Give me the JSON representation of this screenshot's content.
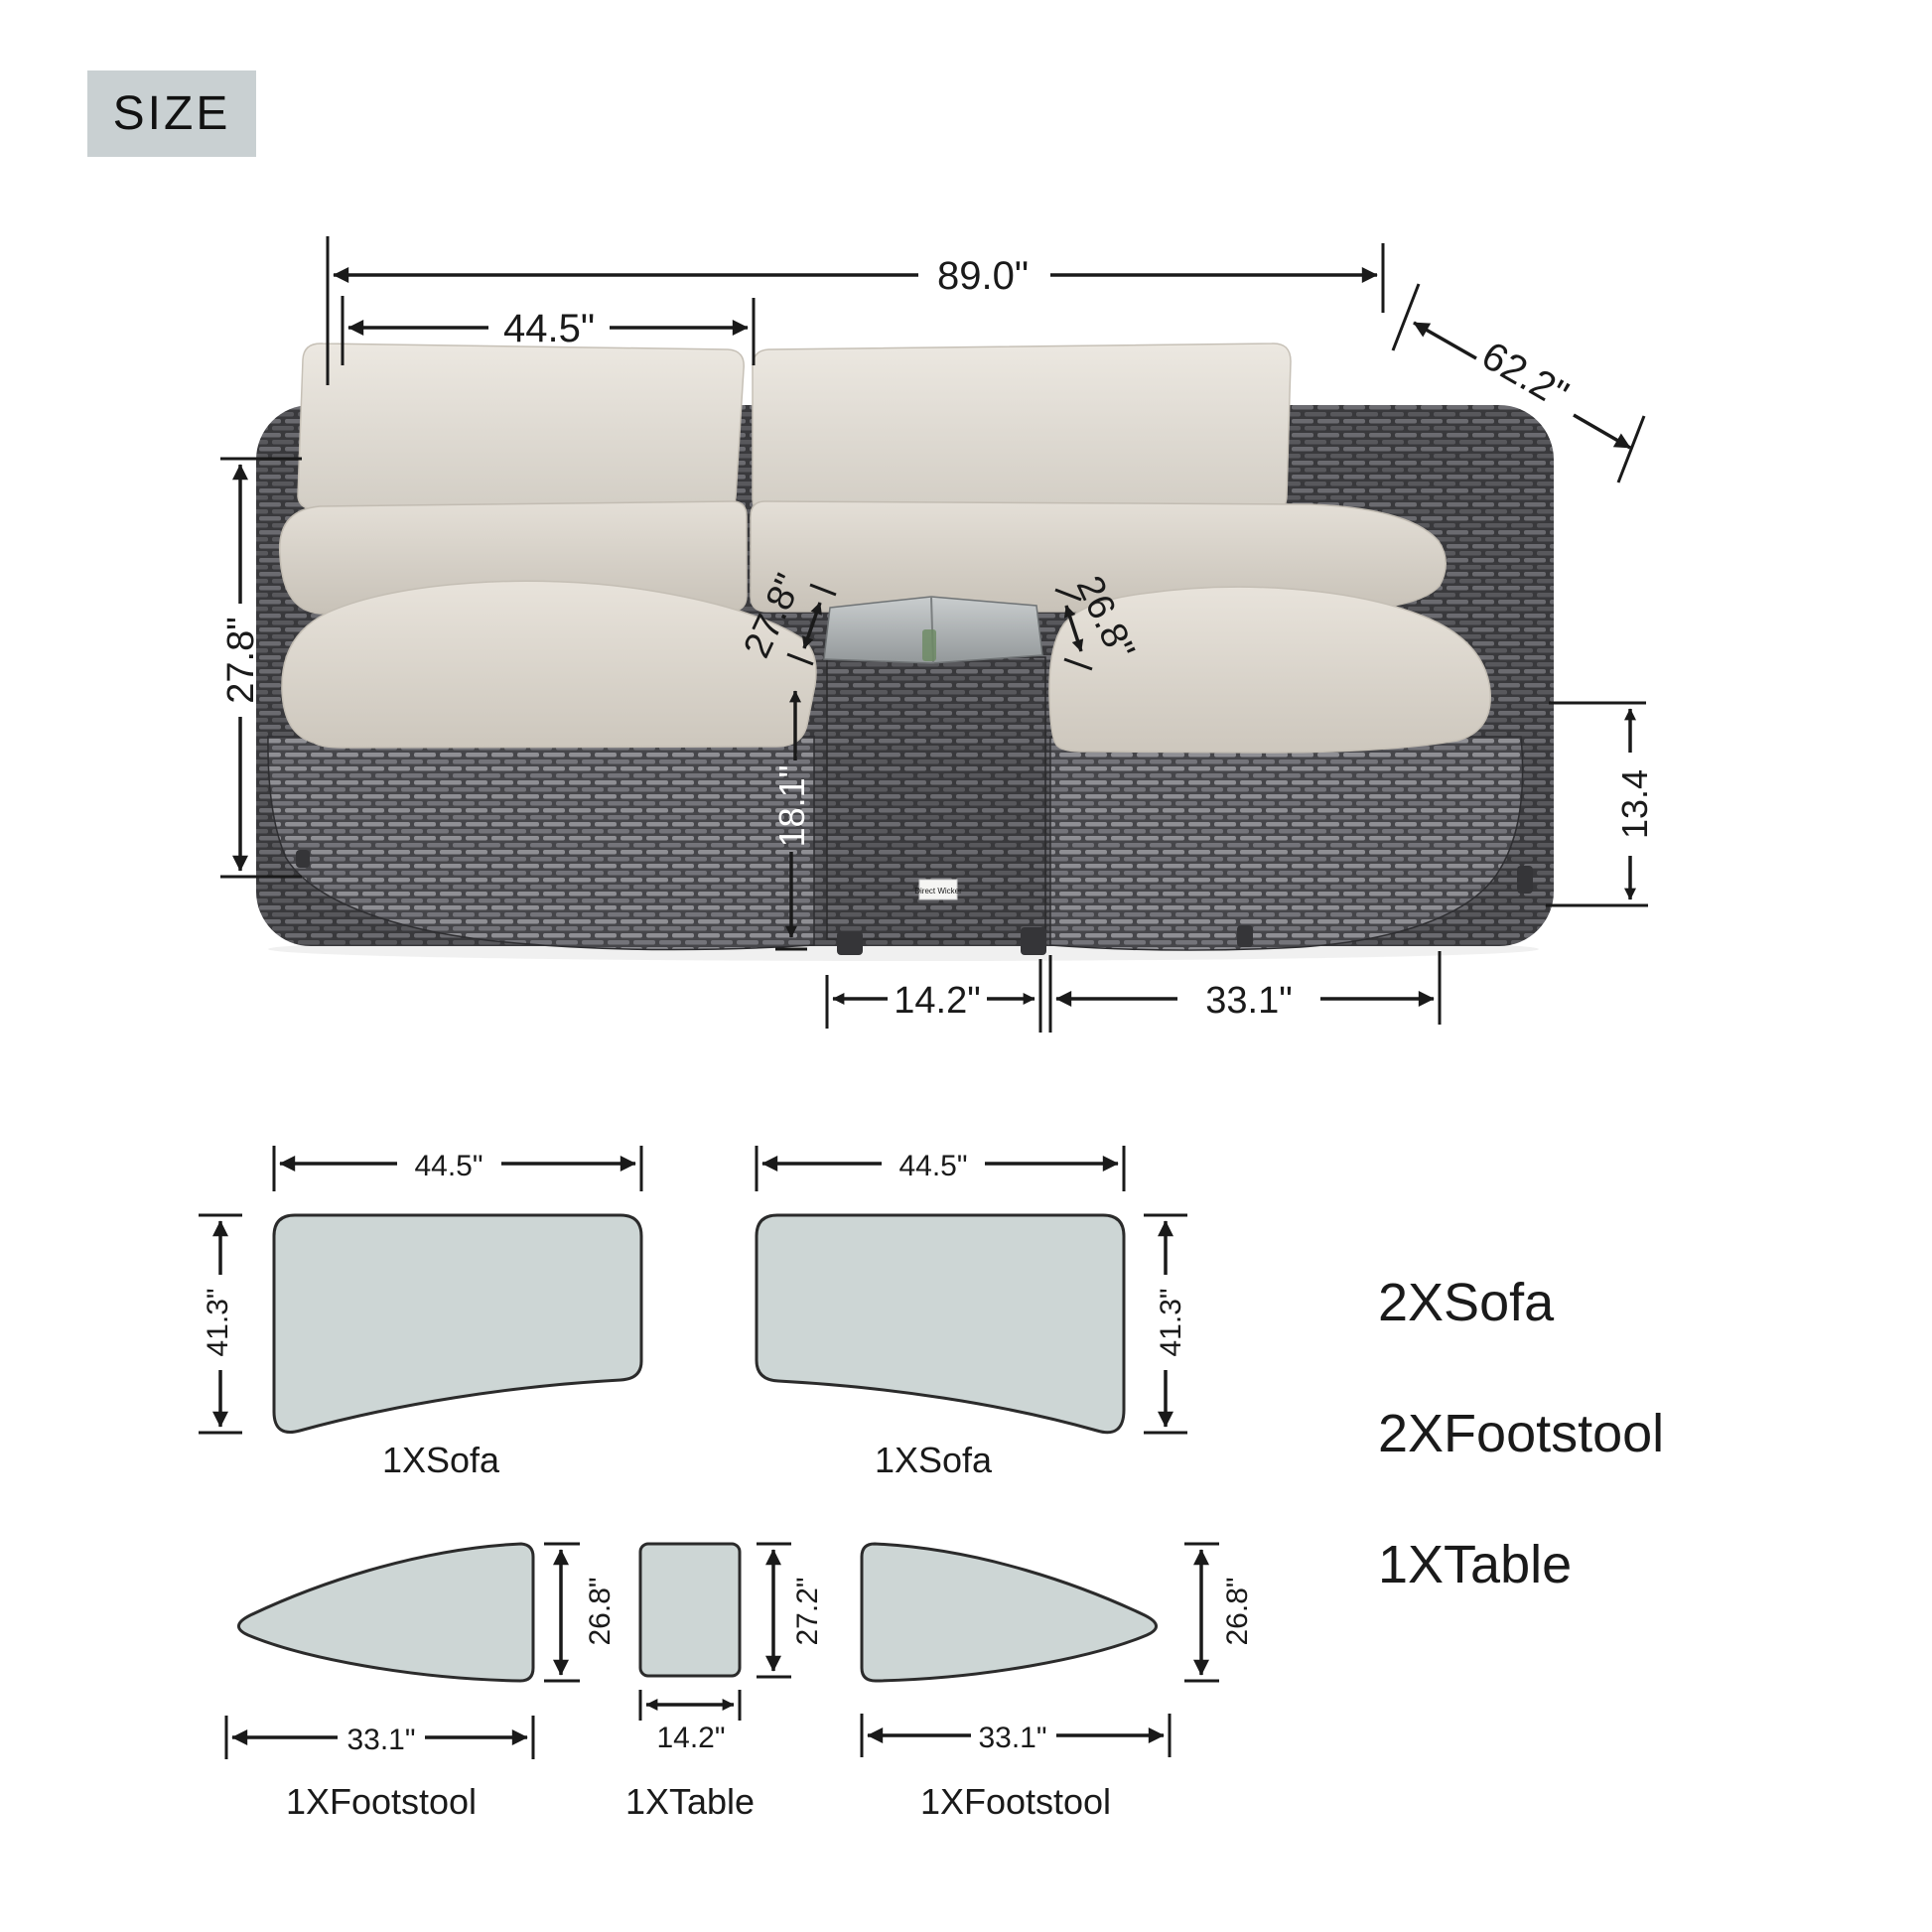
{
  "size_badge": "SIZE",
  "brand_label": "Direct Wicker",
  "photo_dims": {
    "overall_width": "89.0\"",
    "sofa_width": "44.5\"",
    "diagonal_depth": "62.2\"",
    "back_height": "27.8\"",
    "seat_depth_left": "27.8\"",
    "seat_depth_right": "26.8\"",
    "table_height": "18.1\"",
    "footstool_height": "13.4",
    "table_width": "14.2\"",
    "footstool_width": "33.1\""
  },
  "plan": {
    "sofa_left": {
      "width": "44.5\"",
      "depth": "41.3\"",
      "label": "1XSofa"
    },
    "sofa_right": {
      "width": "44.5\"",
      "depth": "41.3\"",
      "label": "1XSofa"
    },
    "footstool_left": {
      "width": "33.1\"",
      "depth": "26.8\"",
      "label": "1XFootstool"
    },
    "table": {
      "width": "14.2\"",
      "depth": "27.2\"",
      "label": "1XTable"
    },
    "footstool_right": {
      "width": "33.1\"",
      "depth": "26.8\"",
      "label": "1XFootstool"
    }
  },
  "parts_list": [
    {
      "label": "2XSofa"
    },
    {
      "label": "2XFootstool"
    },
    {
      "label": "1XTable"
    }
  ],
  "colors": {
    "badge_bg": "#c9d0d2",
    "plan_fill": "#cdd6d5",
    "dim_line": "#1a1a1a",
    "wicker_dark": "#39393c",
    "wicker_light": "#8f8f94",
    "cushion": "#e0dbd3"
  }
}
